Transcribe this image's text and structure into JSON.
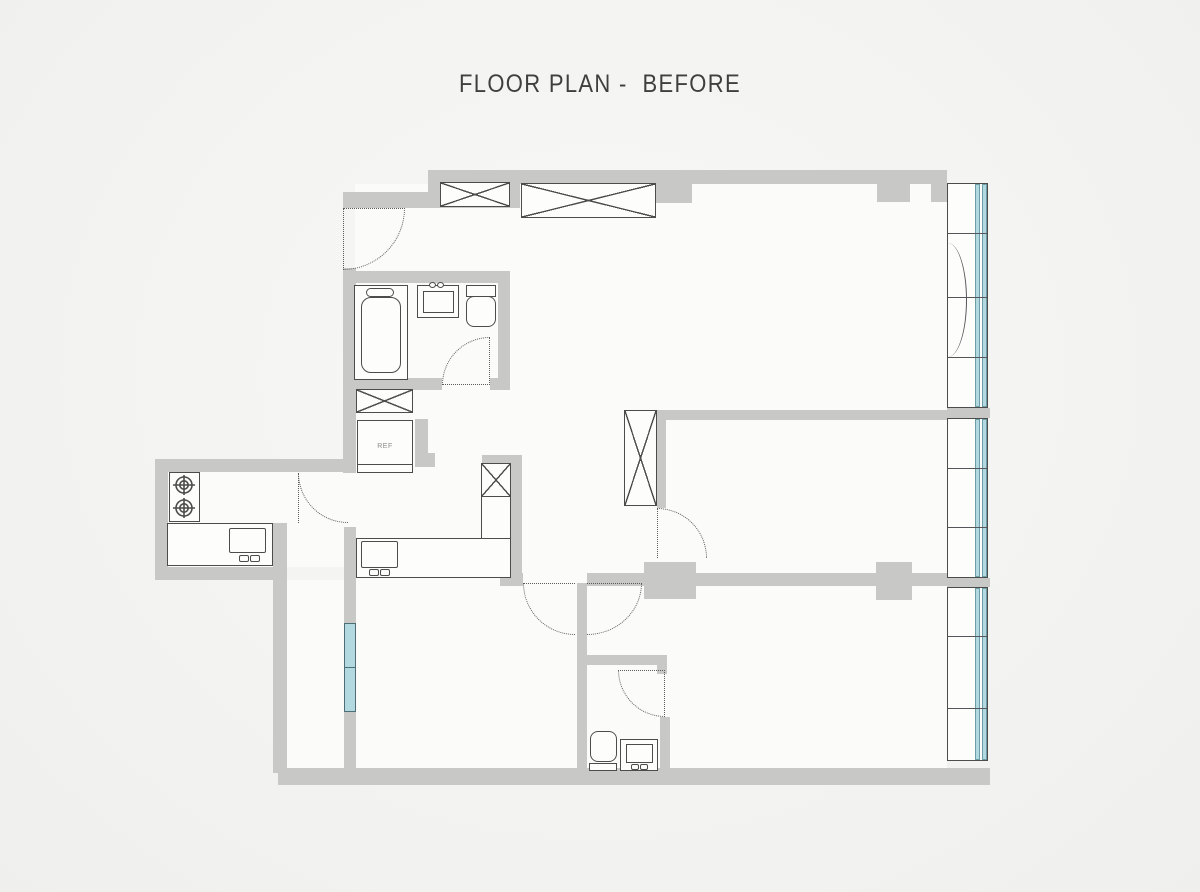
{
  "header": {
    "title": "FLOOR PLAN -  BEFORE"
  },
  "plan": {
    "labels": {
      "refrigerator": "REF"
    },
    "colors": {
      "background": "#f2f2f0",
      "floor": "#fbfbfa",
      "wall": "#c8c8c6",
      "fixture_outline": "#4c4c4a",
      "door_dash": "#5b5b59",
      "glass_fill": "#b2d9df",
      "glass_edge": "#6d9da6",
      "title_text": "#3f3f3f"
    },
    "fixtures": [
      "entry-door",
      "bathtub",
      "bathroom-sink",
      "toilet",
      "bathroom-door",
      "top-wardrobe-small",
      "top-wardrobe-large",
      "washing-machine",
      "refrigerator",
      "gas-stove",
      "kitchen-counter-with-monitor",
      "kitchen-door",
      "l-shaped-desk-with-monitor",
      "desk-cabinet",
      "bedroom-closet",
      "bedroom-door",
      "double-doors",
      "wc-door",
      "wc-toilet",
      "wc-vanity-sink",
      "balcony-window-with-swing",
      "side-windows",
      "left-window"
    ]
  }
}
